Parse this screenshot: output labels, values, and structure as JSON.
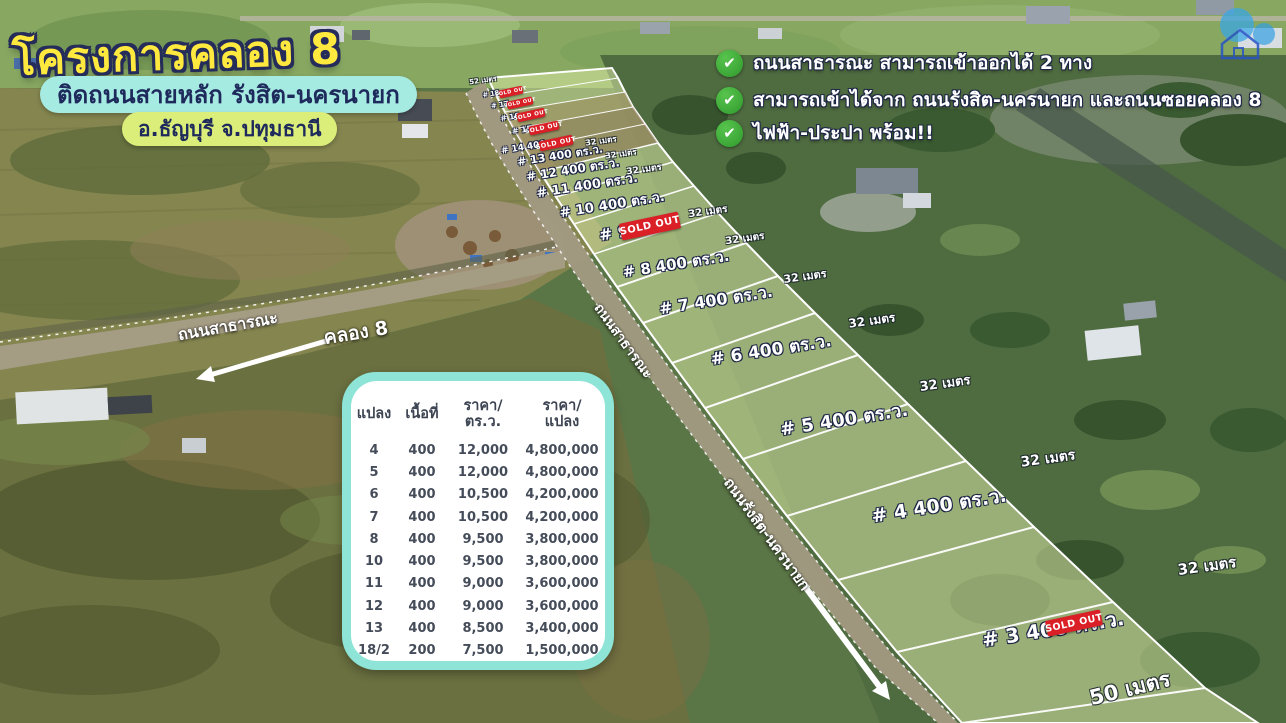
{
  "poster": {
    "title": "โครงการคลอง 8",
    "subtitle": "ติดถนนสายหลัก รังสิต-นครนายก",
    "location": "อ.ธัญบุรี จ.ปทุมธานี"
  },
  "features": {
    "check_icon": "✔",
    "items": [
      {
        "text": "ถนนสาธารณะ สามารถเข้าออกได้ 2 ทาง"
      },
      {
        "text": "สามารถเข้าได้จาก ถนนรังสิต-นครนายก และถนนซอยคลอง 8"
      },
      {
        "text": "ไฟฟ้า-ประปา พร้อม!!"
      }
    ]
  },
  "price_table": {
    "headers": [
      {
        "line1": "แปลง",
        "line2": ""
      },
      {
        "line1": "เนื้อที่",
        "line2": ""
      },
      {
        "line1": "ราคา/",
        "line2": "ตร.ว."
      },
      {
        "line1": "ราคา/",
        "line2": "แปลง"
      }
    ],
    "rows": [
      {
        "plot": "4",
        "area": "400",
        "price_per_sq_wah": "12,000",
        "price_per_plot": "4,800,000"
      },
      {
        "plot": "5",
        "area": "400",
        "price_per_sq_wah": "12,000",
        "price_per_plot": "4,800,000"
      },
      {
        "plot": "6",
        "area": "400",
        "price_per_sq_wah": "10,500",
        "price_per_plot": "4,200,000"
      },
      {
        "plot": "7",
        "area": "400",
        "price_per_sq_wah": "10,500",
        "price_per_plot": "4,200,000"
      },
      {
        "plot": "8",
        "area": "400",
        "price_per_sq_wah": "9,500",
        "price_per_plot": "3,800,000"
      },
      {
        "plot": "10",
        "area": "400",
        "price_per_sq_wah": "9,500",
        "price_per_plot": "3,800,000"
      },
      {
        "plot": "11",
        "area": "400",
        "price_per_sq_wah": "9,000",
        "price_per_plot": "3,600,000"
      },
      {
        "plot": "12",
        "area": "400",
        "price_per_sq_wah": "9,000",
        "price_per_plot": "3,600,000"
      },
      {
        "plot": "13",
        "area": "400",
        "price_per_sq_wah": "8,500",
        "price_per_plot": "3,400,000"
      },
      {
        "plot": "18/2",
        "area": "200",
        "price_per_sq_wah": "7,500",
        "price_per_plot": "1,500,000"
      }
    ]
  },
  "map": {
    "sold_out_label": "SOLD OUT",
    "plots": [
      {
        "label": "# 18",
        "sold": true
      },
      {
        "label": "# 17",
        "sold": true
      },
      {
        "label": "# 16",
        "sold": true
      },
      {
        "label": "# 15",
        "sold": true
      },
      {
        "label": "# 14  400 ตร.ว.",
        "sold": true
      },
      {
        "label": "# 13  400 ตร.ว.",
        "sold": false
      },
      {
        "label": "# 12  400 ตร.ว.",
        "sold": false
      },
      {
        "label": "# 11  400 ตร.ว.",
        "sold": false
      },
      {
        "label": "# 10  400 ตร.ว.",
        "sold": false
      },
      {
        "label": "# 9",
        "sold": true
      },
      {
        "label": "# 8  400 ตร.ว.",
        "sold": false
      },
      {
        "label": "# 7  400 ตร.ว.",
        "sold": false
      },
      {
        "label": "# 6  400 ตร.ว.",
        "sold": false
      },
      {
        "label": "# 5  400 ตร.ว.",
        "sold": false
      },
      {
        "label": "# 4  400 ตร.ว.",
        "sold": false
      },
      {
        "label": "# 3  400 ตร.ว.",
        "sold": true
      }
    ],
    "meters": [
      "52 เมตร",
      "32 เมตร",
      "32 เมตร",
      "32 เมตร",
      "32 เมตร",
      "32 เมตร",
      "32 เมตร",
      "32 เมตร",
      "32 เมตร",
      "32 เมตร",
      "32 เมตร",
      "50 เมตร"
    ],
    "roads": {
      "public_road": "ถนนสาธารณะ",
      "canal": "คลอง 8",
      "frontage_road": "ถนนสาธารณะ",
      "main_road": "ถนนรังสิต-นครนายก"
    }
  }
}
